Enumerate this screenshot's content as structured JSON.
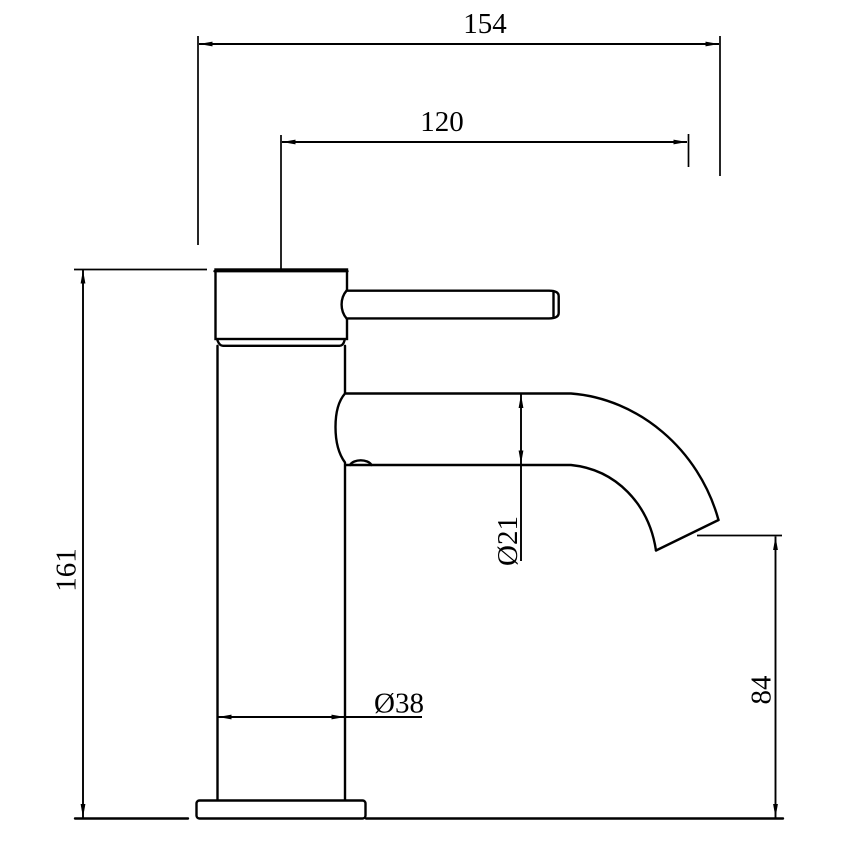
{
  "drawing": {
    "subject": "single-lever basin tap side elevation with dimensions",
    "background_color": "#ffffff",
    "line_color": "#000000",
    "dimensions": {
      "overall_reach": "154",
      "spout_reach": "120",
      "overall_height": "161",
      "spout_diameter": "Ø21",
      "body_diameter": "Ø38",
      "outlet_height": "84"
    }
  }
}
